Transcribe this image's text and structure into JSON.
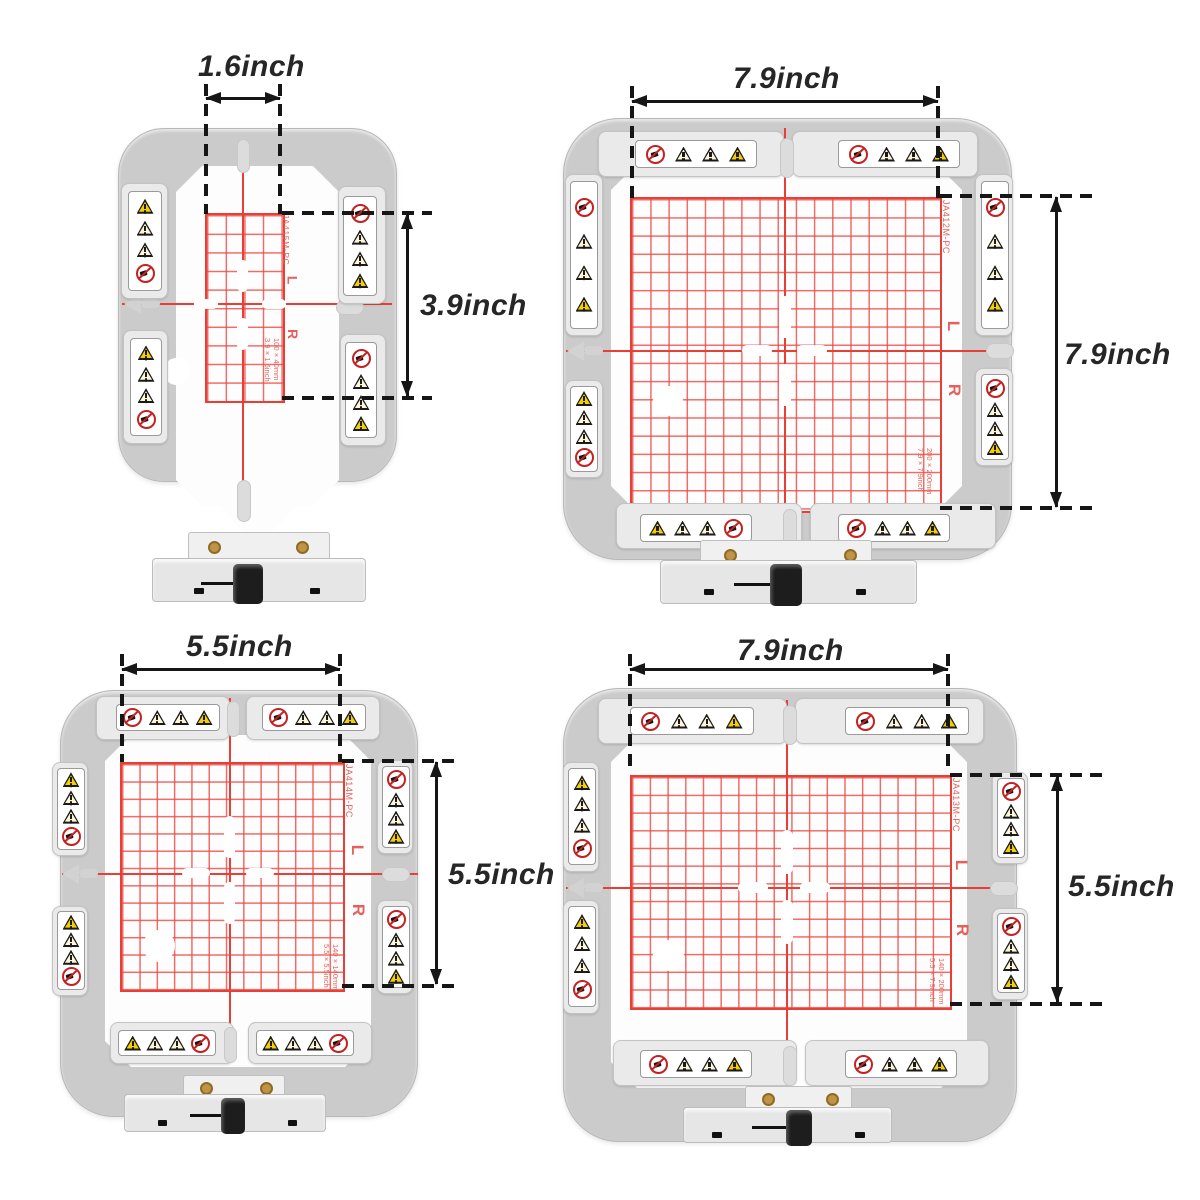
{
  "colors": {
    "frame_gray": "#cbcbcb",
    "bar_gray": "#eaeaea",
    "grid_red": "#e83e36",
    "model_red": "#e4625b",
    "warning_yellow": "#f4ce00",
    "prohibition_red": "#c42222",
    "dimension_black": "#161616"
  },
  "icon_legend": [
    "no-touch-prohibition-icon",
    "hazard-triangle-icon",
    "hazard-triangle-icon",
    "alert-triangle-icon"
  ],
  "hoops": [
    {
      "name": "hoop-1.6x3.9-inch",
      "model": "JA415M-PC",
      "width_label": "1.6inch",
      "height_label": "3.9inch",
      "size_line1": "100×40mm",
      "size_line2": "3.9×1.6inch",
      "left_marker": "L",
      "right_marker": "R"
    },
    {
      "name": "hoop-7.9x7.9-inch",
      "model": "JA412M-PC",
      "width_label": "7.9inch",
      "height_label": "7.9inch",
      "size_line1": "200×200mm",
      "size_line2": "7.9×7.9inch",
      "left_marker": "L",
      "right_marker": "R"
    },
    {
      "name": "hoop-5.5x5.5-inch",
      "model": "JA414M-PC",
      "width_label": "5.5inch",
      "height_label": "5.5inch",
      "size_line1": "140×140mm",
      "size_line2": "5.5×5.5inch",
      "left_marker": "L",
      "right_marker": "R"
    },
    {
      "name": "hoop-7.9x5.5-inch",
      "model": "JA413M-PC",
      "width_label": "7.9inch",
      "height_label": "5.5inch",
      "size_line1": "140×200mm",
      "size_line2": "5.5×7.9inch",
      "left_marker": "L",
      "right_marker": "R"
    }
  ]
}
